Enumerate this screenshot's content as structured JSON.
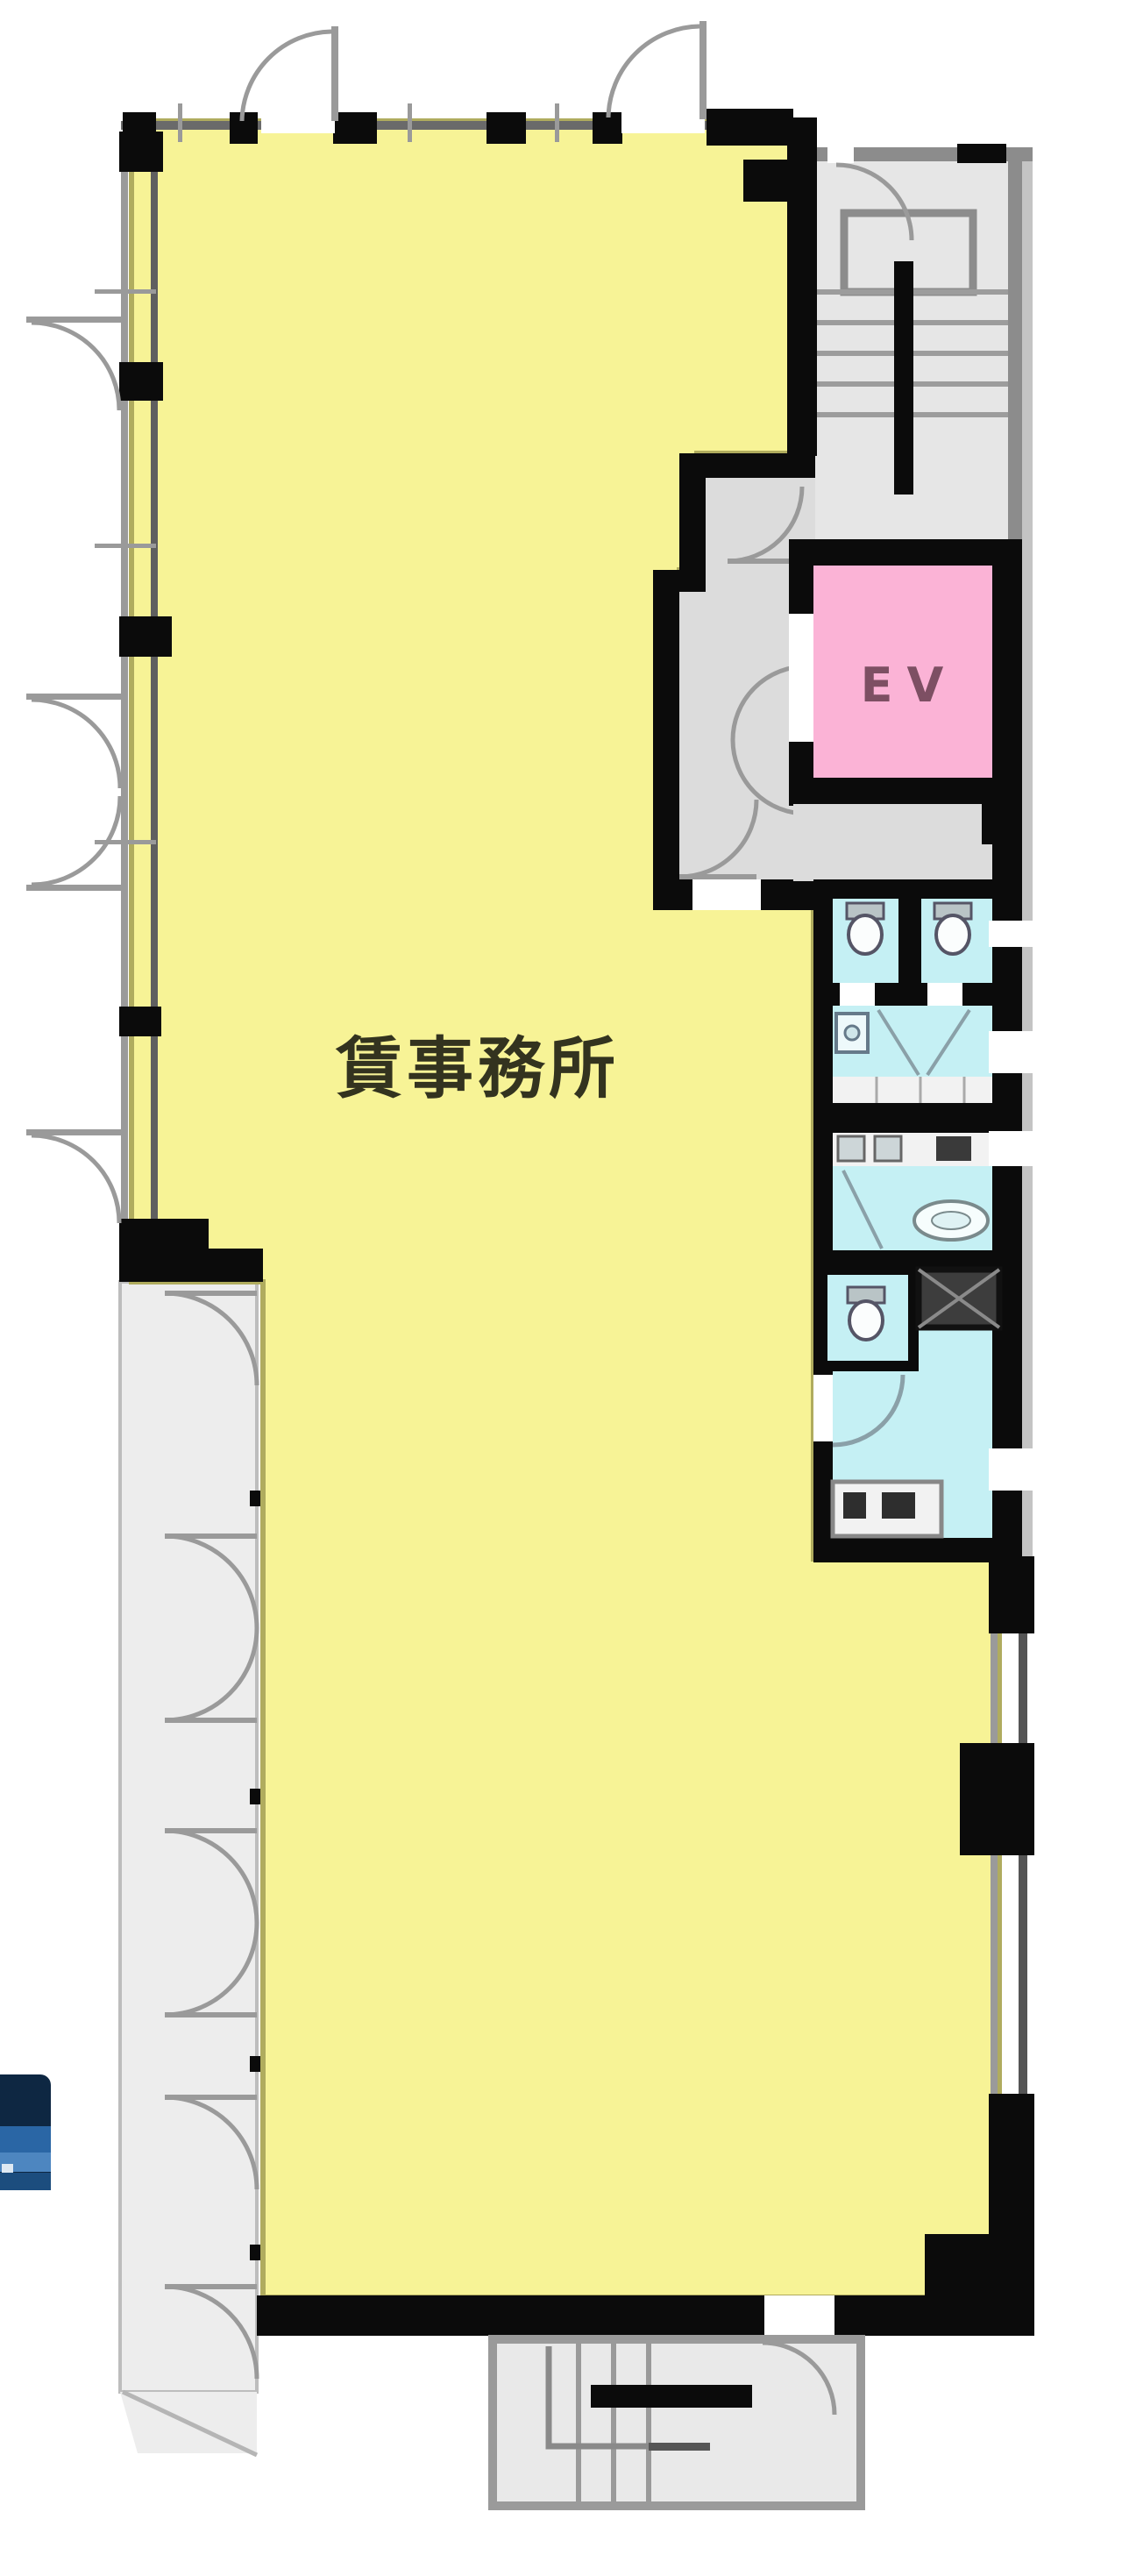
{
  "plan": {
    "office_label": "賃事務所",
    "elevator_label": "EV"
  },
  "colors": {
    "office_fill": "#f7f396",
    "office_edge": "#b0ac5e",
    "elevator_fill": "#fbb3d6",
    "elevator_text": "#7d4f63",
    "wet_area_fill": "#c5f0f4",
    "stair_fill": "#e6e6e6",
    "hall_fill": "#dcdcdc",
    "balcony_fill": "#ededed",
    "counter_fill": "#f2f2f2",
    "wall_black": "#0b0b0b",
    "wall_gray": "#8f8f8f",
    "duct_fill": "#3d3d3d",
    "badge_blue_dark": "#0e2742",
    "badge_blue": "#2a66a5",
    "label_color": "#33331f"
  }
}
